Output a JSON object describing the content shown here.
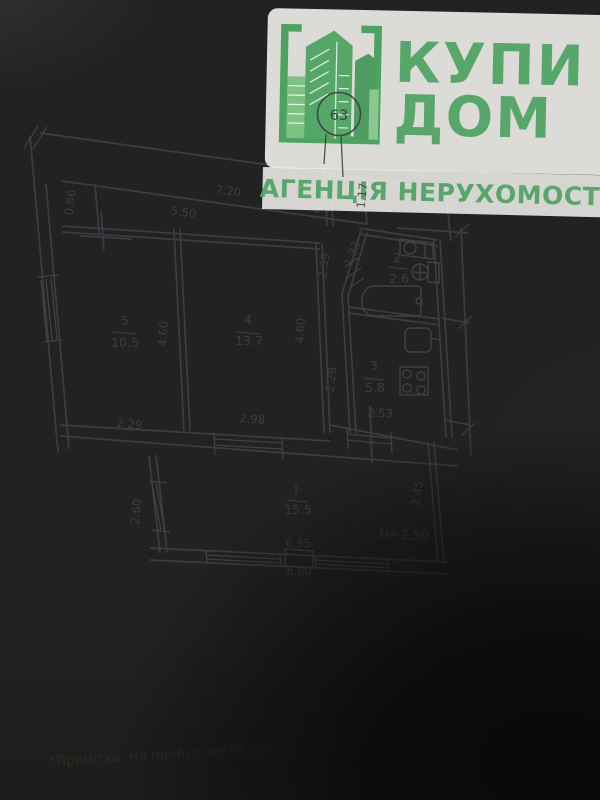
{
  "logo": {
    "title_line1": "КУПИ",
    "title_line2": "ДОМ",
    "subtitle": "АГЕНЦІЯ НЕРУХОМОСТІ",
    "badge": "63",
    "accent_color": "#57a76b"
  },
  "plan": {
    "hall": {
      "area": "8.7"
    },
    "rooms": [
      {
        "number": "5",
        "area": "10.5"
      },
      {
        "number": "4",
        "area": "13.7"
      },
      {
        "number": "2",
        "area": "2.6"
      },
      {
        "number": "3",
        "area": "5.8"
      },
      {
        "number": "I",
        "area": "15.5"
      }
    ],
    "dimensions": {
      "overall_width": "7.20",
      "inner_width": "5.50",
      "niche_depth": "0.86",
      "hall_width": "1.17",
      "bath_wall": "1.33",
      "hall_upper_len": "2.39",
      "hall_lower_len": "2.28",
      "room5_width": "2.29",
      "room5_depth": "4.60",
      "room4_width": "2.98",
      "room4_depth": "4.60",
      "kitchen_width": "2.53",
      "veranda_left": "2.60",
      "veranda_right": "2.45",
      "veranda_inner_width": "6.35",
      "veranda_outer_width": "6.80",
      "ceiling_height": "H=2,50"
    }
  },
  "note": {
    "text": "*Примітка: На прибудову (6,80*2,60) дозвільних документа"
  }
}
